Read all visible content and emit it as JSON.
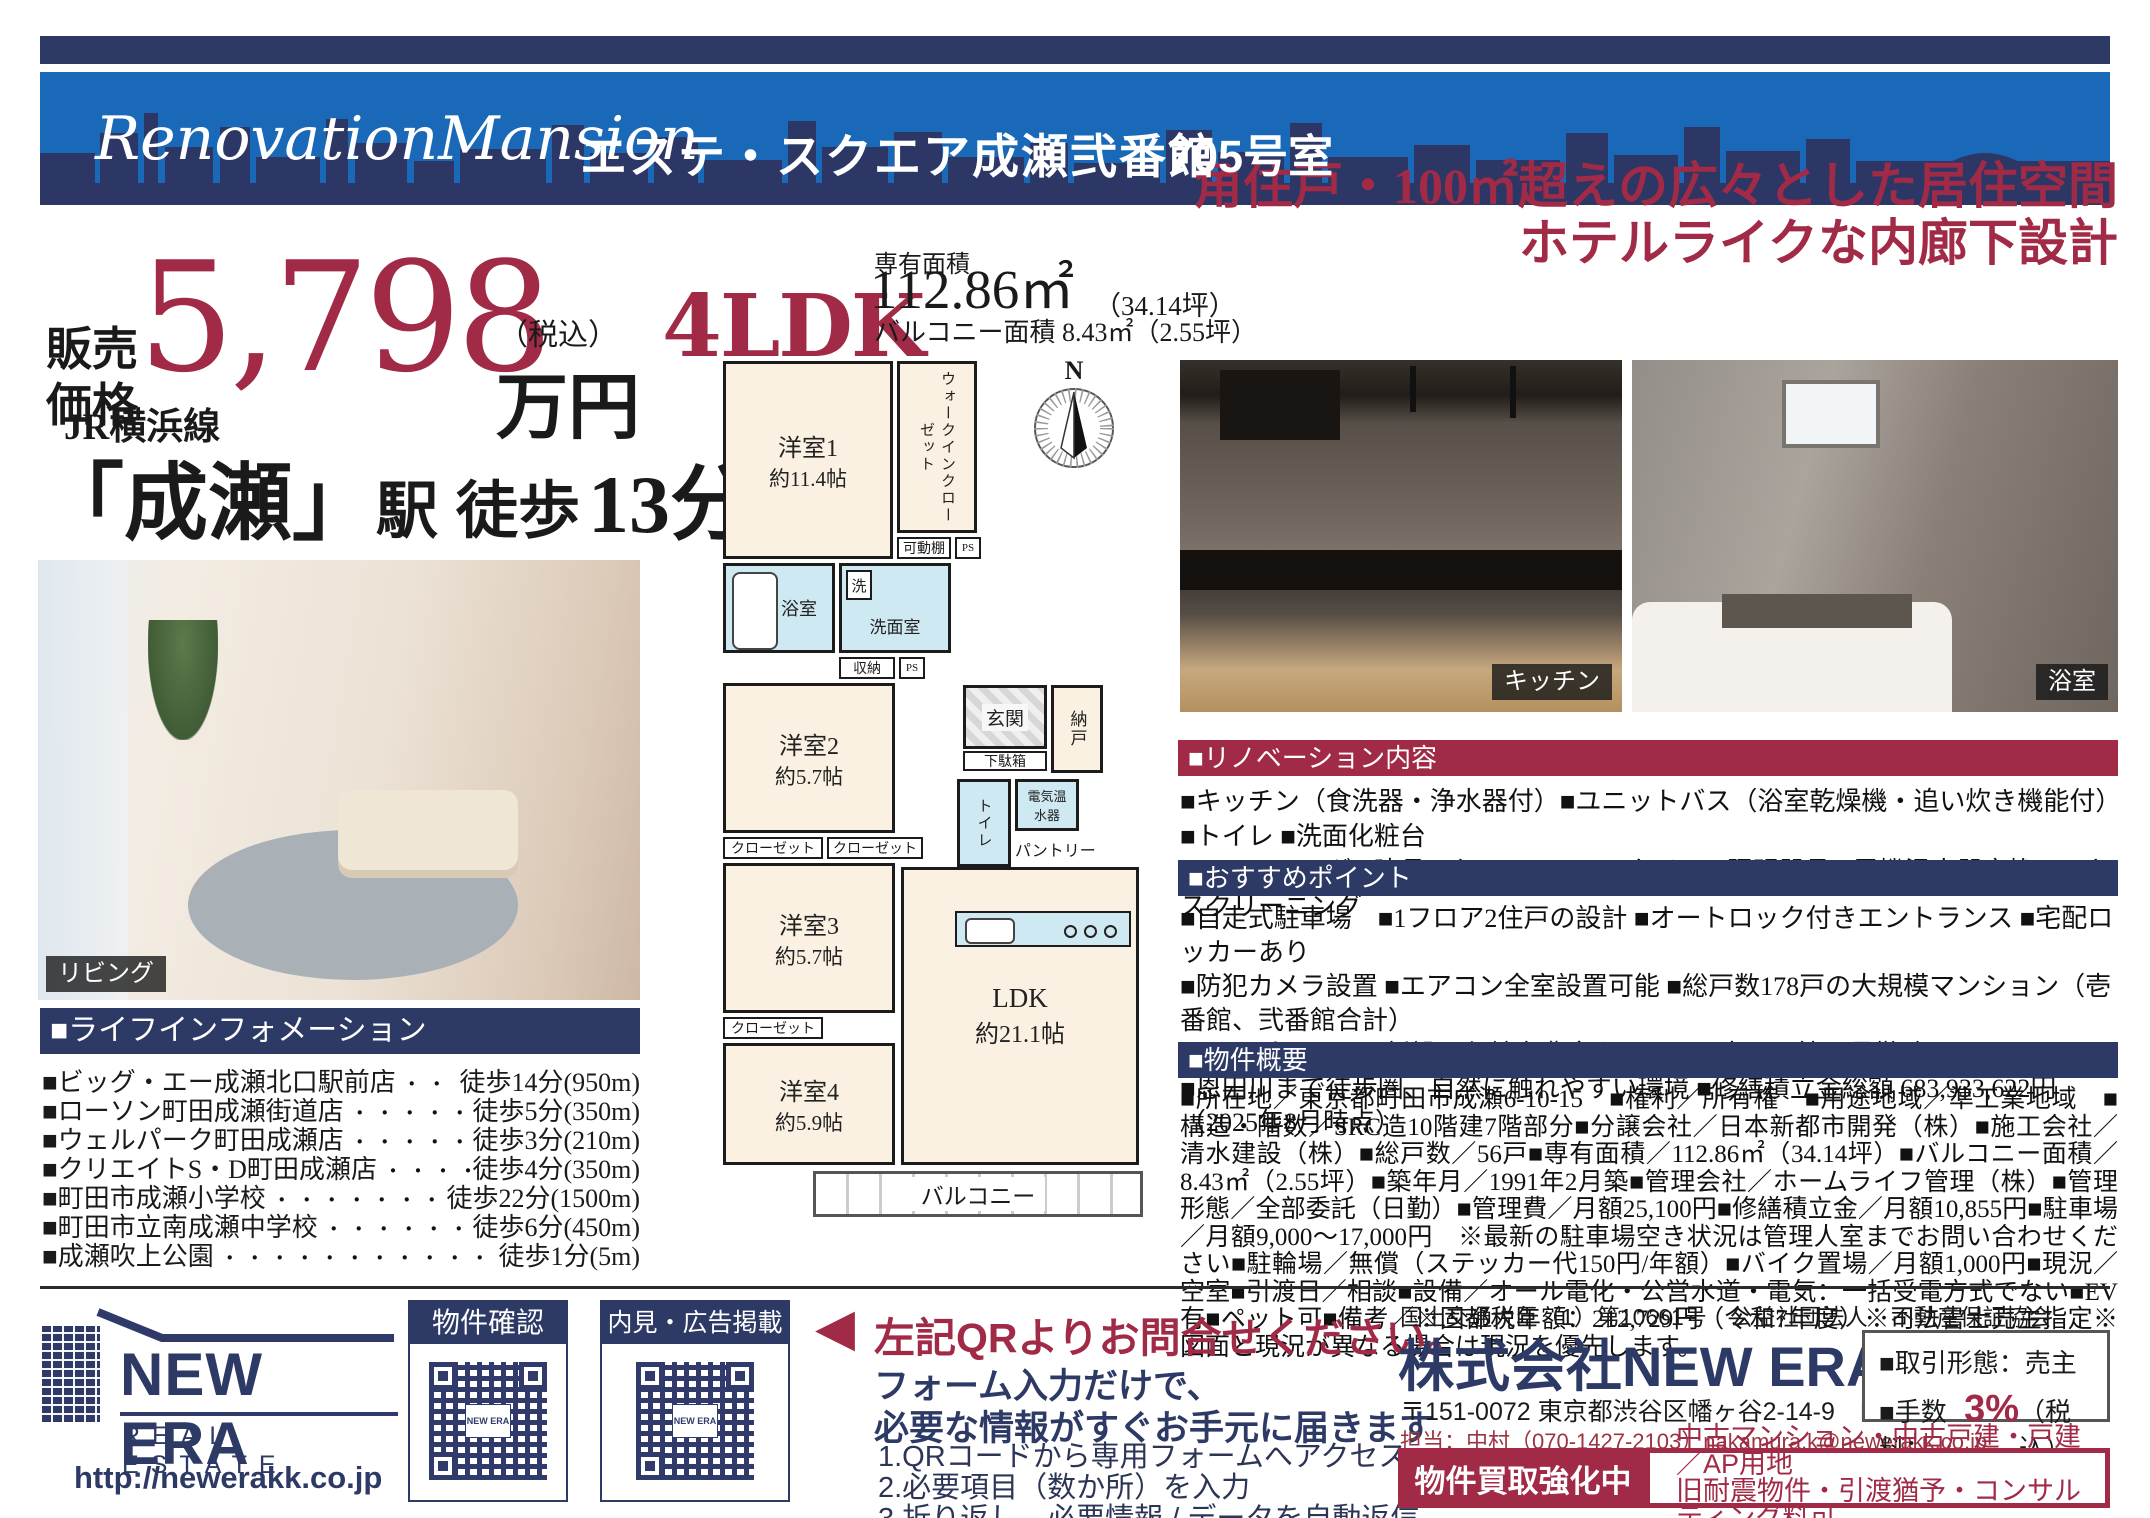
{
  "colors": {
    "navy": "#2e3a66",
    "blue": "#1a69b8",
    "crimson": "#a12a46"
  },
  "header": {
    "brand": "RenovationMansion",
    "building": "エステ・スクエア成瀬弐番館",
    "room": "705号室"
  },
  "price": {
    "label1": "販売",
    "label2": "価格",
    "amount": "5,798",
    "tax_note": "（税込）",
    "unit": "万円"
  },
  "layout": {
    "type": "4LDK",
    "area_label": "専有面積",
    "area_value": "112.86㎡",
    "area_tsubo": "（34.14坪）",
    "balcony_line": "バルコニー面積 8.43㎡（2.55坪）"
  },
  "headline": {
    "line1": "角住戸・100㎡超えの広々とした居住空間",
    "line2": "ホテルライクな内廊下設計"
  },
  "access": {
    "rail_line": "JR横浜線",
    "station": "「成瀬」",
    "eki": "駅",
    "walk": "徒歩",
    "minutes": "13分"
  },
  "photos": {
    "living_caption": "リビング",
    "kitchen_caption": "キッチン",
    "bath_caption": "浴室"
  },
  "life_info": {
    "title": "■ライフインフォメーション",
    "items": [
      {
        "name": "■ビッグ・エー成瀬北口駅前店",
        "value": "徒歩14分(950m)"
      },
      {
        "name": "■ローソン町田成瀬街道店",
        "value": "徒歩5分(350m)"
      },
      {
        "name": "■ウェルパーク町田成瀬店",
        "value": "徒歩3分(210m)"
      },
      {
        "name": "■クリエイトS・D町田成瀬店",
        "value": "徒歩4分(350m)"
      },
      {
        "name": "■町田市成瀬小学校",
        "value": "徒歩22分(1500m)"
      },
      {
        "name": "■町田市立南成瀬中学校",
        "value": "徒歩6分(450m)"
      },
      {
        "name": "■成瀬吹上公園",
        "value": "徒歩1分(5m)"
      }
    ]
  },
  "floor_plan": {
    "compass_n": "N",
    "room1": "洋室1",
    "room1_size": "約11.4帖",
    "wic": "ウォークインクローゼット",
    "shelf": "可動棚",
    "ps": "PS",
    "bath": "浴室",
    "wash_mark": "洗",
    "powder": "洗面室",
    "storage_chip": "収納",
    "room2": "洋室2",
    "room2_size": "約5.7帖",
    "closet": "クローゼット",
    "room3": "洋室3",
    "room3_size": "約5.7帖",
    "room4": "洋室4",
    "room4_size": "約5.9帖",
    "entrance": "玄関",
    "shoebox": "下駄箱",
    "storage_room": "納戸",
    "toilet": "トイレ",
    "heater": "電気温水器",
    "pantry": "パントリー",
    "fridge": "冷",
    "ldk": "LDK",
    "ldk_size": "約21.1帖",
    "balcony": "バルコニー"
  },
  "renovation": {
    "title": "■リノベーション内容",
    "lines": [
      "■キッチン（食洗器・浄水器付）■ユニットバス（浴室乾燥機・追い炊き機能付）■トイレ ■洗面化粧台",
      "■フローリング ■建具 ■クロス ■フロアタイル ■照明器具 ■電機温水器交換 ■ハウスクリーニング"
    ]
  },
  "points": {
    "title": "■おすすめポイント",
    "lines": [
      "■自走式駐車場　■1フロア2住戸の設計 ■オートロック付きエントランス ■宅配ロッカーあり",
      "■防犯カメラ設置 ■エアコン全室設置可能 ■総戸数178戸の大規模マンション（壱番館、弐番館合計）",
      "■WIC/パントリー新設、収納力豊富な間取り ■土日も管理員勤務あり",
      "■恩田川まで徒歩圏、自然に触れやすい環境 ■修繕積立金総額 683,933,622円（2025年8月時点）"
    ]
  },
  "overview": {
    "title": "■物件概要",
    "text": "■所在地／東京都町田市成瀬6-10-15　■権利／所有権　■用途地域／準工業地域　■構造・階数／SRC造10階建7階部分■分譲会社／日本新都市開発（株）■施工会社／清水建設（株）■総戸数／56戸■専有面積／112.86㎡（34.14坪）■バルコニー面積／8.43㎡（2.55坪）■築年月／1991年2月築■管理会社／ホームライフ管理（株）■管理形態／全部委託（日勤）■管理費／月額25,100円■修繕積立金／月額10,855円■駐車場／月額9,000～17,000円　※最新の駐車場空き状況は管理人室までお問い合わせください■駐輪場／無償（ステッカー代150円/年額）■バイク置場／月額1,000円■現況／空室■引渡日／相談■設備／オール電化・公営水道・電気：一括受電方式でない■EV有■ペット可■備考／※固都税年額：212,729円（令和7年度）※司法書士売主指定※図面と現況が異なる場合は現況を優先します。"
  },
  "footer": {
    "logo": {
      "name": "NEW ERA",
      "sub": "REAL ESTATE",
      "url": "http://newerakk.co.jp",
      "qr_mini": "NEW ERA"
    },
    "qr1_title": "物件確認",
    "qr2_title": "内見・広告掲載",
    "cta": {
      "arrow": "◀",
      "headline": "左記QRよりお問合せください。",
      "sub1": "フォーム入力だけで、",
      "sub2": "必要な情報がすぐお手元に届きます",
      "steps": [
        "1.QRコードから専用フォームへアクセス",
        "2.必要項目（数か所）を入力",
        "3.折り返し、必要情報 / データを自動返信"
      ]
    },
    "company": {
      "license": "国土交通大臣（1）第10661号　公益社団法人　不動産保証協会",
      "name": "株式会社NEW ERA",
      "office": "東京本社",
      "address": "〒151-0072 東京都渋谷区幡ヶ谷2-14-9　HARADA Bld.8 6F",
      "contact": "担当：中村（070-1427-2103）nakamura.k@newerakk.co.jp"
    },
    "deal": {
      "type": "■取引形態：売主",
      "fee_prefix": "■手数料：",
      "fee_value": "3%",
      "fee_suffix": "（税込）"
    },
    "buy": {
      "label": "物件買取強化中",
      "line1": "中古マンション・中古戸建・戸建／AP用地",
      "line2": "旧耐震物件・引渡猶予・コンサルティング料可"
    }
  }
}
